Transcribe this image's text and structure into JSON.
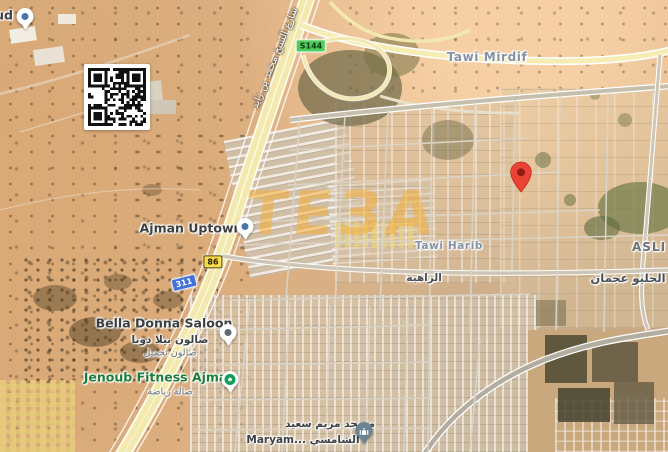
{
  "map": {
    "watermark": {
      "text": "TEЗA",
      "color": "#f0a83a"
    },
    "destination_pin": {
      "color": "#EA4335",
      "inner": "#8F1B12"
    },
    "area_labels": {
      "tawi_mirdif": "Tawi Mirdif",
      "tawi_harib": "Tawi Harib",
      "al_zahia_ar": "الزاهية",
      "asli_partial": "ASLI C",
      "al_helio_ar": "الحليو عجمان",
      "sheikh_mbz_road_ar": "شارع الشيخ محمد بن زايد",
      "partial_left_poi": "ud"
    },
    "pois": {
      "ajman_uptown": {
        "label": "Ajman Uptown"
      },
      "bella_donna": {
        "label": "Bella Donna Saloon",
        "ar1": "صالون بيلا دونا",
        "ar2": "صالون تجميل"
      },
      "jenoub_fitness": {
        "label": "Jenoub Fitness Ajman",
        "ar": "صالة رياضة",
        "color": "#1d7d38"
      },
      "maryam_mosque": {
        "ar1": "مسجد مريم سعيد",
        "line2": "Maryam... الشامسي"
      }
    },
    "route_shields": {
      "s144": "S144",
      "r86": "86",
      "r311": "311"
    }
  }
}
